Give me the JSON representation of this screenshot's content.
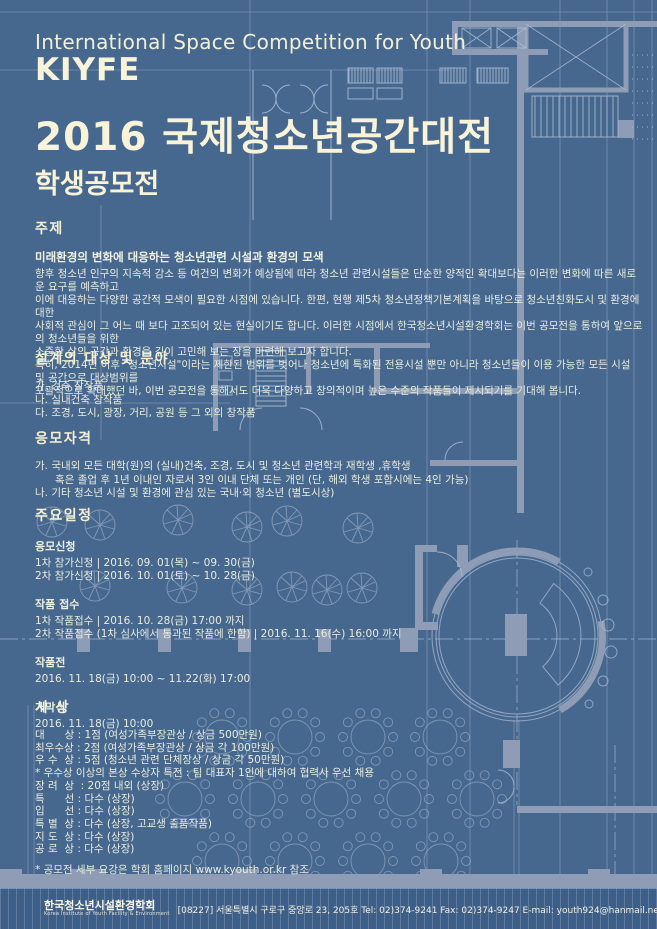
{
  "colors": {
    "background": "#47688e",
    "plan_wall": "#8e9cb6",
    "plan_line": "#aebdd6",
    "title_cream": "#f8f3d9",
    "body_text": "#e9ecdf",
    "footer_band": "#3d5f87"
  },
  "header": {
    "subtitle_en": "International Space Competition for Youth",
    "acronym": "KIYFE",
    "title_ko": "2016 국제청소년공간대전",
    "subtitle_ko": "학생공모전"
  },
  "sections": {
    "theme": {
      "heading": "주제",
      "lead": "미래환경의 변화에 대응하는 청소년관련 시설과 환경의 모색",
      "body": [
        "향후 청소년 인구의 지속적 감소 등 여건의 변화가 예상됨에 따라 청소년 관련시설들은 단순한 양적인 확대보다는 이러한 변화에 따른 새로운 요구를 예측하고",
        "이에 대응하는 다양한 공간적 모색이 필요한 시점에 있습니다. 한편, 현행 제5차 청소년정책기본계획을 바탕으로 청소년친화도시 및 환경에 대한",
        "사회적 관심이 그 어느 때 보다 고조되어 있는 현실이기도 합니다. 이러한 시점에서 한국청소년시설환경학회는 이번 공모전을 통하여 앞으로의 청소년들을 위한",
        "소중한 삶의 공간과 환경을 깊이 고민해 보는 장을 마련해 보고자 합니다.",
        "특히, 2014년 이후 \"청소년시설\"이라는 제한된 범위를 벗어나 청소년에 특화된 전용시설 뿐만 아니라 청소년들이 이용 가능한 모든 시설 및 공간으로 대상범위를",
        "포괄적으로 확대했던 바, 이번 공모전을 통해서도 더욱 다양하고 창의적이며 높은 수준의 작품들이 제시되기를 기대해 봅니다."
      ]
    },
    "fields": {
      "heading": "설계의 대상 및 분야",
      "items": [
        "가. 건축 창작품",
        "나. 실내건축 창작품",
        "다. 조경, 도시, 광장, 거리, 공원 등 그 외의 창작품"
      ]
    },
    "eligibility": {
      "heading": "응모자격",
      "items": [
        "가. 국내외 모든 대학(원)의 (실내)건축, 조경, 도시 및 청소년 관련학과 재학생 ,휴학생",
        "      혹은 졸업 후 1년 이내인 자로서 3인 이내 단체 또는 개인 (단, 해외 학생 포함시에는 4인 가능)",
        "나. 기타 청소년 시설 및 환경에 관심 있는 국내·외 청소년 (별도시상)"
      ]
    },
    "schedule": {
      "heading": "주요일정",
      "groups": [
        {
          "title": "응모신청",
          "lines": [
            "1차 참가신청 | 2016. 09. 01(목) ~ 09. 30(금)",
            "2차 참가신청 | 2016. 10. 01(토) ~ 10. 28(금)"
          ]
        },
        {
          "title": "작품 접수",
          "lines": [
            "1차 작품접수 | 2016. 10. 28(금) 17:00 까지",
            "2차 작품접수 (1차 심사에서 통과된 작품에 한함) | 2016. 11. 16(수) 16:00 까지"
          ]
        },
        {
          "title": "작품전",
          "lines": [
            "2016. 11. 18(금) 10:00 ~ 11.22(화) 17:00"
          ]
        },
        {
          "title": "개막식",
          "lines": [
            "2016. 11. 18(금) 10:00"
          ]
        }
      ]
    },
    "awards": {
      "heading": "시 상",
      "items": [
        "대      상 : 1점 (여성가족부장관상 / 상금 500만원)",
        "최우수상 : 2점 (여성가족부장관상 / 상금 각 100만원)",
        "우 수  상 : 5점 (청소년 관련 단체장상 / 상금 각 50만원)",
        "* 우수상 이상의 본상 수상자 특전 : 팀 대표자 1인에 대하여 협력사 우선 채용",
        "장 려  상  : 20점 내외 (상장)",
        "특      선 : 다수 (상장)",
        "입      선 : 다수 (상장)",
        "특 별  상 : 다수 (상장, 고교생 출품작품)",
        "지 도  상 : 다수 (상장)",
        "공 로  상 : 다수 (상장)"
      ],
      "footnote": "* 공모전 세부 요강은 학회 홈페이지 www.kyouth.or.kr 참조",
      "website": "www.kyouth.or.kr"
    }
  },
  "footer": {
    "org_ko": "한국청소년시설환경학회",
    "org_en": "Korea Institute of Youth Facility & Environment",
    "address": "[08227] 서울특별시 구로구 중앙로 23, 205호  Tel: 02)374-9241  Fax: 02)374-9247  E-mail: youth924@hanmail.net"
  }
}
